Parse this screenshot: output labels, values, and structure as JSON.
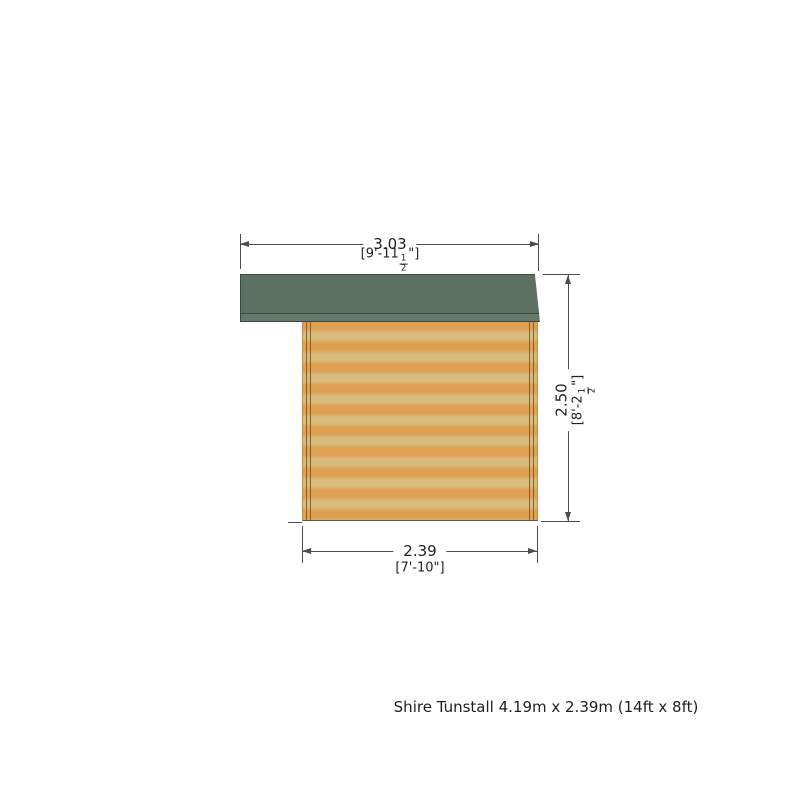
{
  "diagram": {
    "caption": "Shire Tunstall 4.19m x 2.39m (14ft x 8ft)",
    "dimensions": {
      "roof_width": {
        "metric": "3.03",
        "imperial_prefix": "[9'-11",
        "frac_num": "1",
        "frac_den": "2",
        "imperial_suffix": "\"]"
      },
      "overall_height": {
        "metric": "2.50",
        "imperial_prefix": "[8'-2",
        "frac_num": "1",
        "frac_den": "2",
        "imperial_suffix": "\"]"
      },
      "wall_width": {
        "metric": "2.39",
        "imperial": "[7'-10\"]"
      }
    },
    "colors": {
      "roof_main": "#5c7164",
      "roof_fascia": "#67796b",
      "roof_edge": "#3b4840",
      "wall_light": "#d7bc7e",
      "wall_dark": "#dfa054",
      "wall_edge": "#bd9048",
      "wall_base": "#5c564a",
      "trim_line": "#7d5223",
      "dim_line": "#4d4d4d",
      "text": "#1f1f1f",
      "background": "#ffffff"
    }
  }
}
